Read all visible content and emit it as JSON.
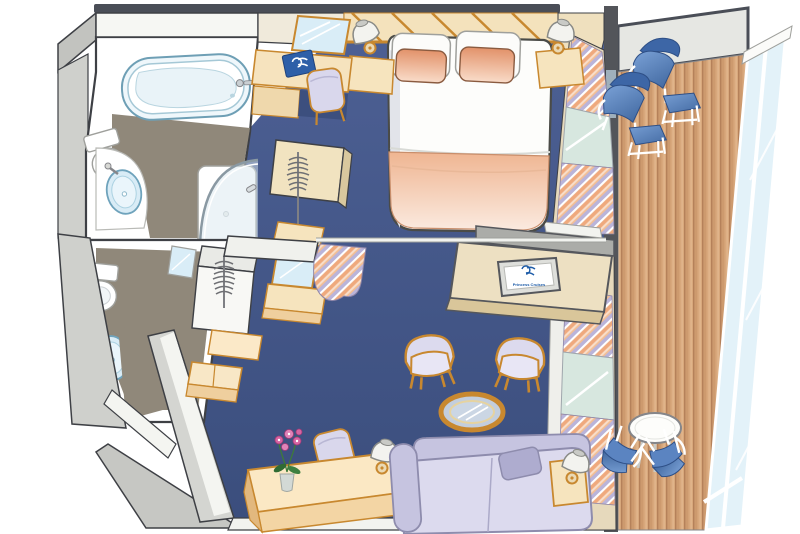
{
  "scene": {
    "aria_label": "Isometric floor plan illustration of a cruise ship suite: bedroom with queen bed, sitting area, two bathrooms, walk-in wardrobe and a private teak balcony with glass railing",
    "background_color": "#FFFFFF"
  },
  "tv": {
    "logo_icon": "seawitch-logo",
    "logo_text": "Princess Cruises",
    "logo_color": "#1E5CA8"
  },
  "desk_book": {
    "logo_icon": "seawitch-logo",
    "cover_color": "#2E5FA8"
  },
  "palette": {
    "carpet_top": "#4D6094",
    "carpet_bottom": "#3B4E7D",
    "deck_plank": "#D8A87C",
    "deck_plank_line": "#B5815A",
    "wall_light": "#D7D8D4",
    "wall_mid": "#C6C7C3",
    "wall_outline": "#3E4045",
    "bathroom_floor_taupe": "#90887A",
    "furniture_cream": "#F8E7C3",
    "furniture_cream_shade": "#EFCF9E",
    "trim_gold": "#C8882F",
    "upholstery_lavender": "#D9D7EC",
    "upholstery_lavender_deep": "#C3C1DE",
    "pillow_peach": "#E89E74",
    "balcony_seat_blue": "#5B84C1",
    "balcony_seat_blue_dark": "#3D66A6",
    "glass_blue": "#D9EDF7",
    "window_glass": "#D7E7DF",
    "white": "#FFFFFF"
  },
  "inventory": {
    "bathroom_main": [
      "bathtub",
      "toilet",
      "sink",
      "curved-shower"
    ],
    "bathroom_second": [
      "toilet",
      "sink",
      "mirror"
    ],
    "wardrobe_area": [
      "hanger-rack",
      "hanger-rack",
      "vanity-mirror",
      "ottoman-bench"
    ],
    "bedroom": [
      "queen-bed",
      "white-pillows",
      "peach-pillows",
      "nightstand-left",
      "nightstand-right",
      "table-lamps",
      "desk",
      "desk-chair",
      "desk-mirror",
      "logo-book",
      "tv-cabinet",
      "flat-tv"
    ],
    "sitting_area": [
      "armchair",
      "armchair",
      "round-glass-coffee-table",
      "sofa",
      "throw-pillow",
      "side-table",
      "credenza",
      "orchid-plant",
      "chair",
      "table-lamp"
    ],
    "balcony": [
      "teak-deck",
      "glass-railing",
      "lounge-chair",
      "lounge-chair",
      "footstool",
      "footstool",
      "round-table",
      "dining-chair",
      "dining-chair"
    ],
    "divider": [
      "curtain-rod",
      "curtain"
    ],
    "window_wall": [
      "striped-curtains",
      "window-glass",
      "balcony-door"
    ]
  }
}
